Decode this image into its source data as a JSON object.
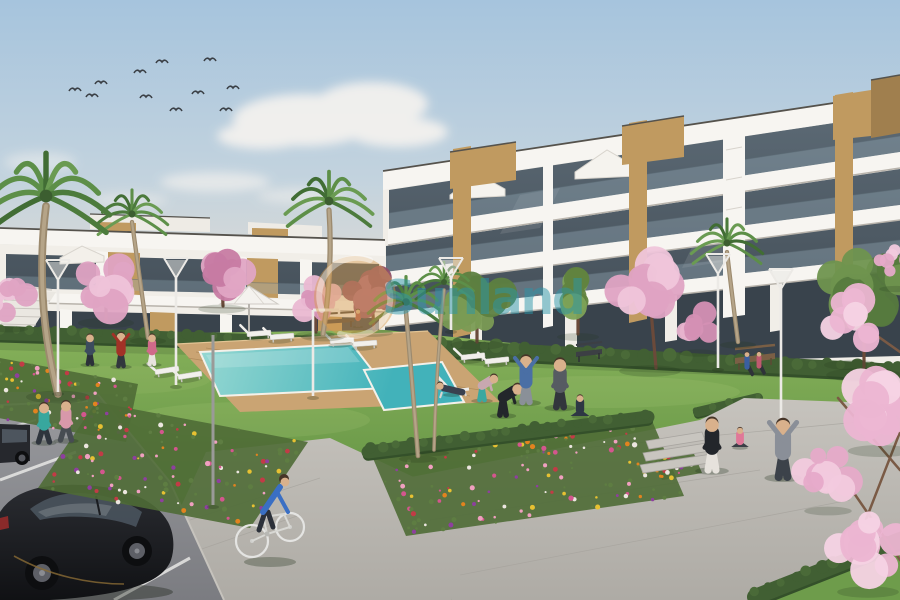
{
  "image_type": "architectural-render-photo",
  "description": "New-build white apartment complex with communal pool, lawns, flower beds, palm and blossom trees, people exercising, cyclist and parked cars",
  "watermark": {
    "text": "Sunland",
    "text_color": "#2a96aa",
    "logo_color": "#d79b4d",
    "ring_color": "#ffffff"
  },
  "palette": {
    "sky_top": "#a6c4dd",
    "sky_mid": "#c3d3de",
    "sky_haze": "#e3dcd3",
    "sky_low": "#ebe3d8",
    "cloud": "#f6f3ef",
    "wall": "#f1eee8",
    "fascia": "#f7f5f1",
    "edge_dark": "#55524c",
    "slab_shadow": "#b8b3ab",
    "glass_hi": "#5d6b76",
    "glass_lo": "#3d4750",
    "glass_ground": "#39434c",
    "rail": "#96aab9",
    "wood": "#c09a60",
    "wood_dark": "#a07f4e",
    "grass_light": "#86b15a",
    "grass_mid": "#6e9c4b",
    "grass_dark": "#55803c",
    "hedge": "#415f33",
    "hedge_dark": "#34502a",
    "pool_light": "#96d8d2",
    "pool_deep": "#42b2ba",
    "deck": "#caa473",
    "deck_line": "#b08c5c",
    "path_light": "#c6c3bd",
    "path_dark": "#aeaba5",
    "joint": "#a5a29c",
    "asphalt_light": "#9a9b9f",
    "asphalt_dark": "#7b7c81",
    "marking": "#e8e8e6",
    "trunk": "#6b4a3a",
    "palm_trunk": "#9c8a6e",
    "car_body_hi": "#2a2c31",
    "car_body_lo": "#101114",
    "skin": "#d9b18c",
    "hair": "#463528"
  },
  "scene": {
    "seed": 11,
    "birds": [
      [
        75,
        90
      ],
      [
        92,
        96
      ],
      [
        101,
        83
      ],
      [
        140,
        72
      ],
      [
        146,
        97
      ],
      [
        162,
        62
      ],
      [
        176,
        110
      ],
      [
        198,
        93
      ],
      [
        210,
        60
      ],
      [
        226,
        110
      ],
      [
        233,
        88
      ]
    ],
    "hedges_base": [
      [
        0,
        333,
        385,
        345,
        7
      ],
      [
        384,
        345,
        900,
        372,
        8
      ],
      [
        698,
        412,
        758,
        398,
        5
      ]
    ],
    "hedges_mid": [
      [
        368,
        452,
        648,
        417,
        6.5
      ]
    ],
    "hedges_corner": [
      [
        755,
        597,
        900,
        540,
        8
      ]
    ],
    "loungers": [
      [
        258,
        334,
        -4
      ],
      [
        281,
        337,
        -4
      ],
      [
        341,
        341,
        -4
      ],
      [
        364,
        344,
        -4
      ],
      [
        166,
        371,
        -9
      ],
      [
        189,
        376,
        -9
      ],
      [
        472,
        357,
        -6
      ],
      [
        496,
        361,
        -6
      ]
    ],
    "flower_colors": [
      "#e2831f",
      "#d4568e",
      "#8e3f9e",
      "#ece6e0",
      "#c23b46",
      "#e7c132",
      "#f0a0c0"
    ],
    "flowerbeds": [
      {
        "o": [
          0,
          358
        ],
        "u": [
          138,
          26
        ],
        "v": [
          -12,
          58
        ],
        "n": 70
      },
      {
        "o": [
          96,
          402
        ],
        "u": [
          212,
          40
        ],
        "v": [
          -58,
          86
        ],
        "n": 115
      },
      {
        "o": [
          372,
          456
        ],
        "u": [
          278,
          -40
        ],
        "v": [
          34,
          80
        ],
        "n": 130
      },
      {
        "o": [
          652,
          456
        ],
        "u": [
          40,
          -7
        ],
        "v": [
          10,
          24
        ],
        "n": 25
      }
    ],
    "trees": [
      {
        "kind": "palm",
        "c": [
          132,
          214
        ],
        "r": 36,
        "trunk": [
          [
            132,
            222
          ],
          [
            140,
            280
          ],
          [
            148,
            338
          ]
        ]
      },
      {
        "kind": "green",
        "c": [
          578,
          297
        ],
        "r": 30,
        "c1": "#61833f",
        "c2": "#7da257",
        "n": 10,
        "trunk": [
          [
            578,
            334
          ],
          [
            578,
            304
          ]
        ]
      },
      {
        "kind": "green",
        "c": [
          477,
          300
        ],
        "r": 38,
        "c1": "#5d7f40",
        "c2": "#7a9b54",
        "n": 13,
        "trunk": [
          [
            477,
            342
          ],
          [
            477,
            308
          ]
        ]
      },
      {
        "kind": "blossom",
        "c": [
          650,
          288
        ],
        "r": 44,
        "c1": "#dfa3c3",
        "c2": "#efc5da",
        "n": 13,
        "trunk": [
          [
            656,
            368
          ],
          [
            651,
            310
          ]
        ]
      },
      {
        "kind": "blossom",
        "c": [
          698,
          322
        ],
        "r": 28,
        "c1": "#d490b4",
        "c2": "#e7b3cd",
        "n": 9
      },
      {
        "kind": "palm",
        "c": [
          727,
          243
        ],
        "r": 36,
        "trunk": [
          [
            727,
            252
          ],
          [
            732,
            295
          ],
          [
            738,
            342
          ]
        ]
      },
      {
        "kind": "green",
        "c": [
          864,
          290
        ],
        "r": 54,
        "c1": "#567a3e",
        "c2": "#6f934e",
        "n": 15,
        "trunk": [
          [
            864,
            372
          ],
          [
            864,
            318
          ]
        ]
      },
      {
        "kind": "blossom",
        "c": [
          106,
          284
        ],
        "r": 40,
        "c1": "#dfa3c3",
        "c2": "#eec3d9",
        "n": 13,
        "trunk": [
          [
            106,
            320
          ],
          [
            106,
            292
          ]
        ]
      },
      {
        "kind": "blossom",
        "c": [
          222,
          272
        ],
        "r": 34,
        "c1": "#c77ba3",
        "c2": "#e0a5c4",
        "n": 11,
        "trunk": [
          [
            223,
            306
          ],
          [
            222,
            280
          ]
        ]
      },
      {
        "kind": "blossom",
        "c": [
          315,
          300
        ],
        "r": 28,
        "c1": "#d895b8",
        "c2": "#eab8d2",
        "n": 10,
        "trunk": [
          [
            316,
            332
          ],
          [
            315,
            306
          ]
        ]
      },
      {
        "kind": "blossom",
        "c": [
          372,
          294
        ],
        "r": 30,
        "c1": "#8e4e66",
        "c2": "#a9647e",
        "n": 10,
        "trunk": [
          [
            374,
            330
          ],
          [
            372,
            300
          ]
        ]
      },
      {
        "kind": "palm",
        "c": [
          329,
          201
        ],
        "r": 44,
        "trunk": [
          [
            329,
            210
          ],
          [
            333,
            270
          ],
          [
            323,
            334
          ]
        ]
      },
      {
        "kind": "blossom",
        "c": [
          10,
          300
        ],
        "r": 26,
        "c1": "#dfa3c3",
        "c2": "#eec3d9",
        "n": 8
      },
      {
        "kind": "palm",
        "c": [
          46,
          196
        ],
        "r": 64,
        "trunk": [
          [
            46,
            206
          ],
          [
            34,
            300
          ],
          [
            58,
            394
          ]
        ]
      },
      {
        "kind": "palm",
        "c": [
          406,
          302
        ],
        "r": 38,
        "trunk": [
          [
            406,
            312
          ],
          [
            412,
            380
          ],
          [
            418,
            456
          ]
        ]
      },
      {
        "kind": "palm",
        "c": [
          444,
          282
        ],
        "r": 30,
        "trunk": [
          [
            444,
            290
          ],
          [
            436,
            370
          ],
          [
            434,
            450
          ]
        ]
      }
    ],
    "overhang": {
      "branches": [
        [
          900,
          560,
          845,
          480
        ],
        [
          900,
          470,
          838,
          398
        ],
        [
          900,
          352,
          852,
          318
        ],
        [
          858,
          540,
          900,
          432
        ]
      ],
      "clusters": [
        {
          "c": [
            896,
            262
          ],
          "r": 24,
          "c1": "#e6aac9",
          "c2": "#f2cade",
          "n": 7
        },
        {
          "c": [
            852,
            322
          ],
          "r": 40,
          "c1": "#ecb5d2",
          "c2": "#f6d3e4",
          "n": 11
        },
        {
          "c": [
            880,
            402
          ],
          "r": 46,
          "c1": "#ecb5d2",
          "c2": "#f6d3e4",
          "n": 12
        },
        {
          "c": [
            828,
            474
          ],
          "r": 34,
          "c1": "#e6aac9",
          "c2": "#f2cade",
          "n": 10
        },
        {
          "c": [
            868,
            545
          ],
          "r": 44,
          "c1": "#ecb5d2",
          "c2": "#f6d3e4",
          "n": 11
        }
      ]
    },
    "lamps": [
      [
        58,
        258,
        392,
        "Y"
      ],
      [
        176,
        256,
        385,
        "Y"
      ],
      [
        313,
        310,
        396,
        "L"
      ],
      [
        451,
        256,
        330,
        "Y"
      ],
      [
        718,
        252,
        368,
        "Y"
      ],
      [
        781,
        267,
        477,
        "Y"
      ],
      [
        213,
        335,
        505,
        "P"
      ]
    ],
    "people": [
      [
        90,
        364,
        32,
        "#3c4c5e",
        "#2b3139",
        "stand"
      ],
      [
        121,
        366,
        36,
        "#a23227",
        "#31373d",
        "stretch"
      ],
      [
        152,
        364,
        32,
        "#d06a8a",
        "#e8e4de",
        "stand"
      ],
      [
        44,
        442,
        42,
        "#38a79e",
        "#2e343d",
        "walk"
      ],
      [
        66,
        440,
        42,
        "#d898aa",
        "#474c52",
        "walk"
      ],
      [
        482,
        400,
        36,
        "#c8a8b0",
        "#3aa8a0",
        "bend"
      ],
      [
        503,
        415,
        44,
        "#23262b",
        "#23262b",
        "bend"
      ],
      [
        526,
        402,
        50,
        "#4a6fa5",
        "#8a9098",
        "stretch"
      ],
      [
        560,
        407,
        52,
        "#565b62",
        "#32363c",
        "stand"
      ],
      [
        580,
        416,
        28,
        "#2e3744",
        "#2e3744",
        "sitcross"
      ],
      [
        452,
        394,
        30,
        "#39414f",
        "#39414f",
        "lie"
      ],
      [
        712,
        470,
        56,
        "#23262b",
        "#e6e2dc",
        "stand"
      ],
      [
        740,
        447,
        26,
        "#e07898",
        "#3a3f46",
        "sitcross"
      ],
      [
        783,
        477,
        62,
        "#8a8f98",
        "#3c424a",
        "stretch"
      ],
      [
        747,
        369,
        20,
        "#3a5fa0",
        "#2f3339",
        "sit"
      ],
      [
        759,
        368,
        19,
        "#c05a70",
        "#2f3339",
        "sit"
      ],
      [
        358,
        326,
        18,
        "#b05a50",
        "#42464c",
        "stand"
      ]
    ]
  }
}
